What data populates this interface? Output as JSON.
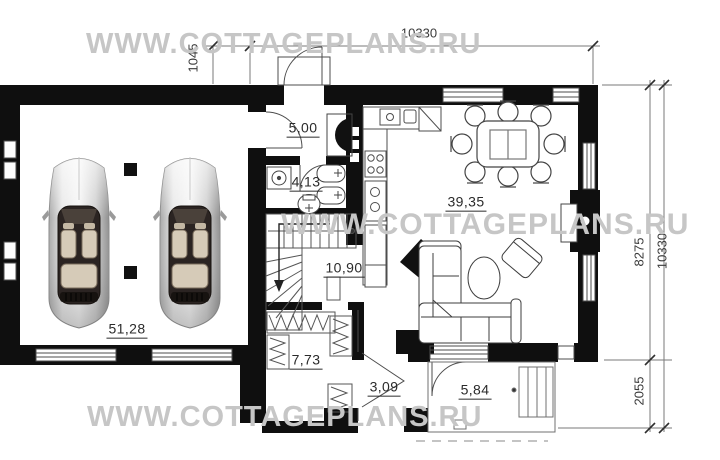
{
  "watermark": {
    "text": "WWW.COTTAGEPLANS.RU"
  },
  "dimensions": {
    "top_width": "10330",
    "porch_offset": "1045",
    "house_depth": "8275",
    "total_depth": "10330",
    "porch_depth": "2055"
  },
  "rooms": {
    "hall": "5,00",
    "bathroom": "4,13",
    "kitchen_living": "39,35",
    "stair_hall": "10,90",
    "garage": "51,28",
    "wardrobe": "7,73",
    "vestibule": "3,09",
    "porch": "5,84"
  }
}
